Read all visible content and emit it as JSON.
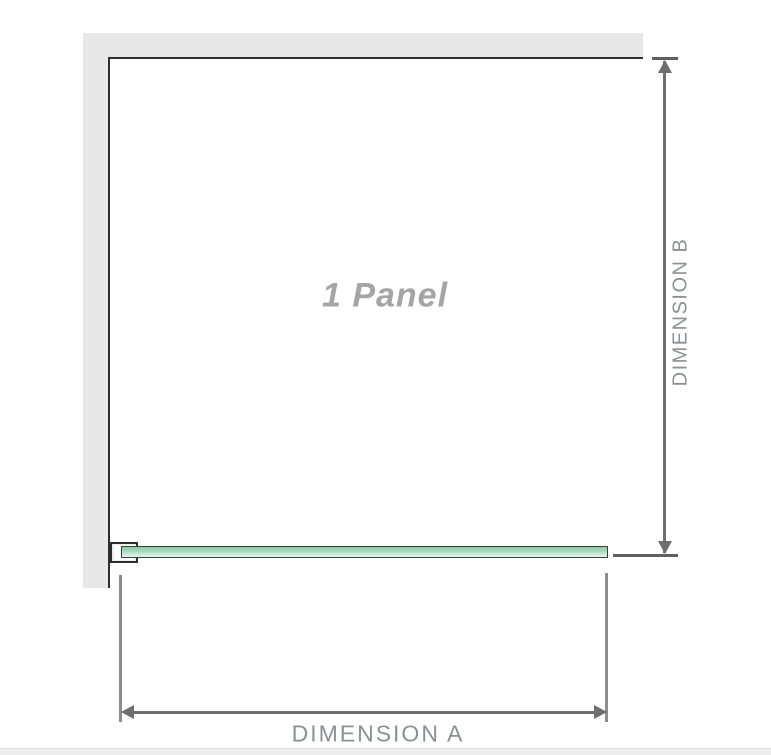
{
  "diagram": {
    "panel_label": "1 Panel",
    "dimension_a_label": "DIMENSION A",
    "dimension_b_label": "DIMENSION B",
    "colors": {
      "background": "#ffffff",
      "wall_fill": "#e8e8e8",
      "outline": "#2e2e2e",
      "dim_line": "#6e6e6e",
      "dim_tick": "#5f5f5f",
      "ext_line": "#8c8c8c",
      "label_text": "#8b9095",
      "panel_text": "#a5a5a5",
      "glass_border": "#33423a",
      "glass_top": "#8fc9a8",
      "glass_mid": "#aadabe",
      "glass_light": "#cdeadb",
      "glass_bottom": "#e6f5ec",
      "bracket_fill": "#ececec",
      "footer_strip": "#ededed",
      "footer_edge": "#dcdcdc"
    }
  }
}
